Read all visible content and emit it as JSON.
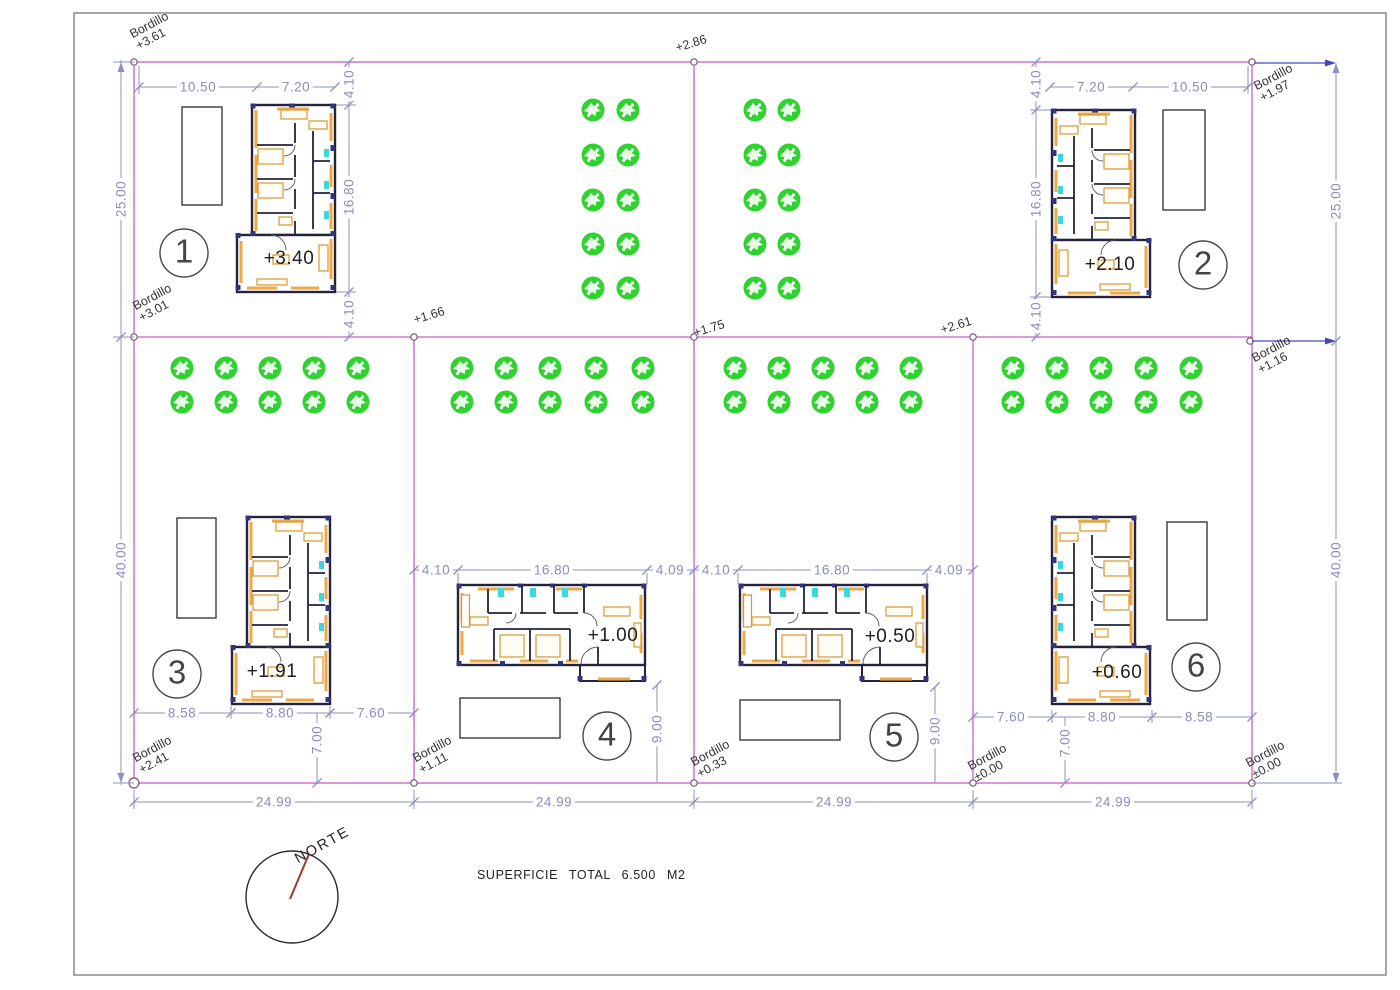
{
  "sheet": {
    "north_label": "NORTE",
    "area_label": "SUPERFICIE TOTAL 6.500 M2"
  },
  "plots": [
    {
      "number": "1",
      "elevation": "+3.40"
    },
    {
      "number": "2",
      "elevation": "+2.10"
    },
    {
      "number": "3",
      "elevation": "+1.91"
    },
    {
      "number": "4",
      "elevation": "+1.00"
    },
    {
      "number": "5",
      "elevation": "+0.50"
    },
    {
      "number": "6",
      "elevation": "+0.60"
    }
  ],
  "bordillo": [
    {
      "label": "Bordillo",
      "value": "+3.61"
    },
    {
      "label": "Bordillo",
      "value": "+1.97"
    },
    {
      "label": "Bordillo",
      "value": "+3.01"
    },
    {
      "label": "Bordillo",
      "value": "+1.16"
    },
    {
      "label": "Bordillo",
      "value": "+2.41"
    },
    {
      "label": "Bordillo",
      "value": "+1.11"
    },
    {
      "label": "Bordillo",
      "value": "+0.33"
    },
    {
      "label": "Bordillo",
      "value": "±0.00"
    },
    {
      "label": "Bordillo",
      "value": "±0.00"
    }
  ],
  "spot_elevations": [
    "+2.86",
    "+1.66",
    "+1.75",
    "+2.61"
  ],
  "dims": {
    "p1_top": [
      "10.50",
      "7.20"
    ],
    "p1_side": [
      "4.10",
      "16.80",
      "4.10"
    ],
    "p2_top": [
      "7.20",
      "10.50"
    ],
    "p2_side": [
      "4.10",
      "16.80",
      "4.10"
    ],
    "p3_bot": [
      "8.58",
      "8.80",
      "7.60"
    ],
    "p3_v": "7.00",
    "p4_top": [
      "4.10",
      "16.80",
      "4.09"
    ],
    "p4_v": "9.00",
    "p5_top": [
      "4.10",
      "16.80",
      "4.09"
    ],
    "p5_v": "9.00",
    "p6_bot": [
      "7.60",
      "8.80",
      "8.58"
    ],
    "p6_v": "7.00",
    "left": [
      "25.00",
      "40.00"
    ],
    "right": [
      "25.00",
      "40.00"
    ],
    "bottom": [
      "24.99",
      "24.99",
      "24.99",
      "24.99"
    ]
  },
  "colors": {
    "plot_line": "#c85fc8",
    "dimension": "#8e90c2",
    "dimension_arrow": "#4646c0",
    "tree": "#2fd32f",
    "wall": "#23233d",
    "furniture": "#d8962f",
    "fixture": "#3bd7e0",
    "needle": "#9a3a33"
  }
}
